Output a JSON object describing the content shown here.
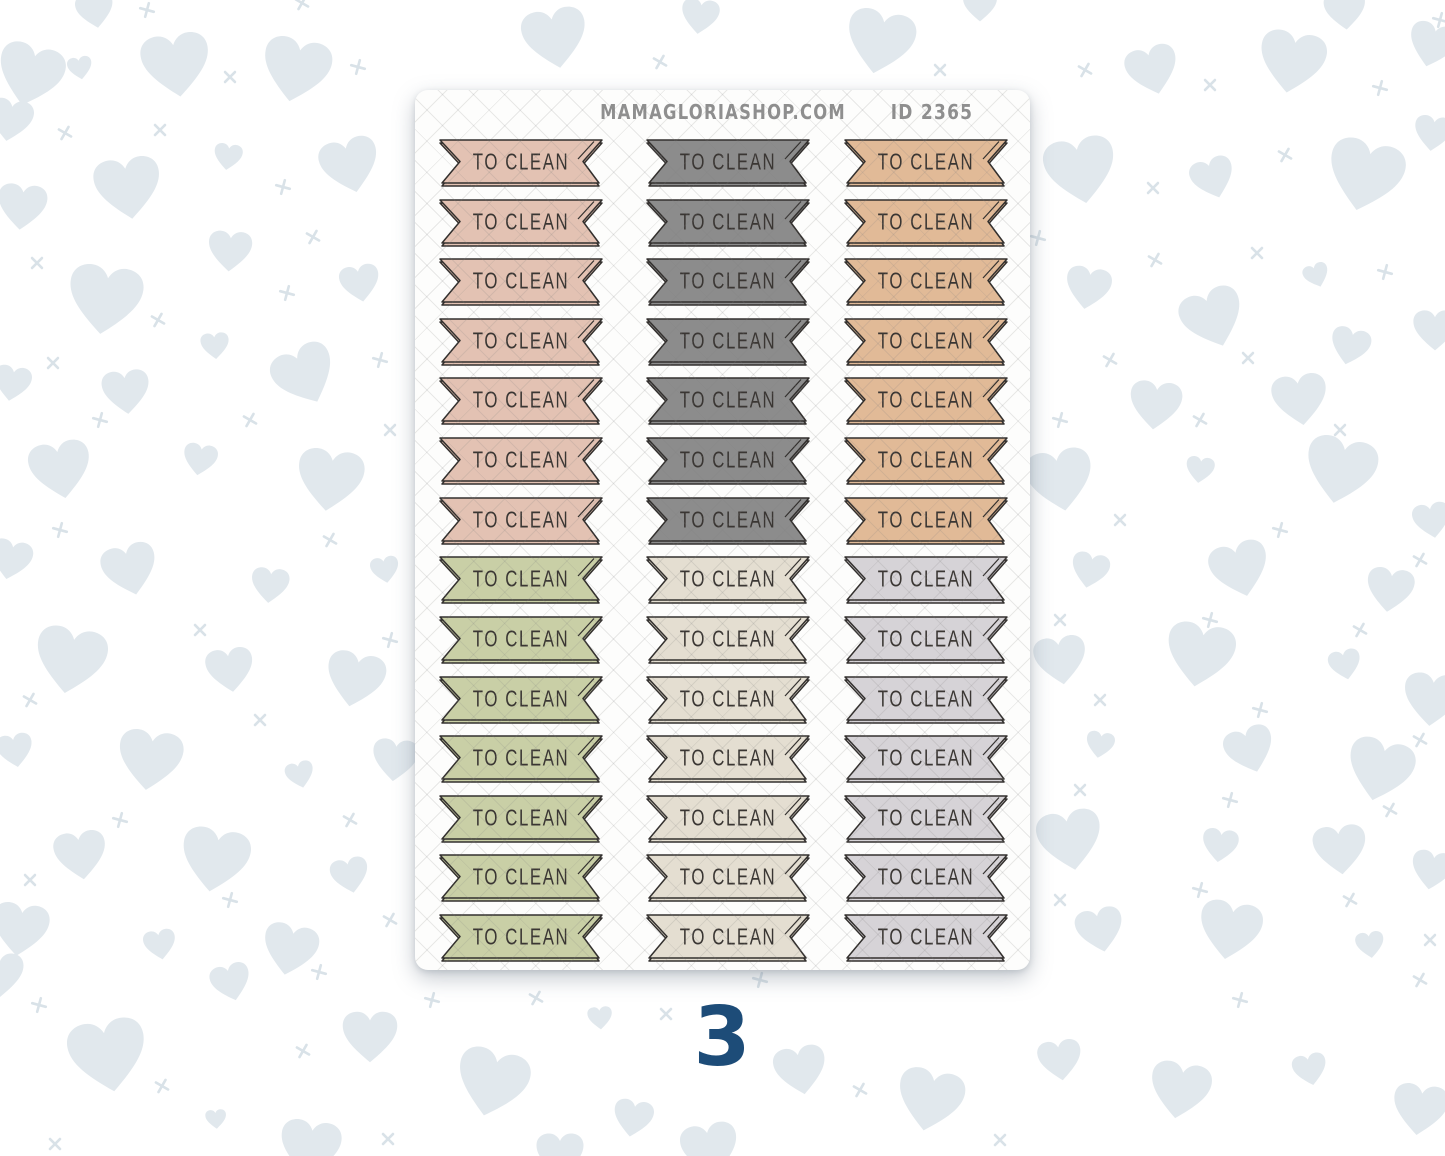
{
  "page": {
    "page_number": "3",
    "page_number_color": "#1d4c78",
    "background_color": "#ffffff",
    "heart_color": "#e1e8ed",
    "cross_color": "#d9e2e8"
  },
  "sheet": {
    "site_name": "MAMAGLORIASHOP.COM",
    "sheet_id": "ID 2365",
    "header_text_color": "#8f8f8f",
    "background_color": "#fdfdfc",
    "outline_color": "#33302e",
    "label_text_color": "#3a3633",
    "flag_label": "TO CLEAN",
    "columns": 3,
    "rows": [
      {
        "label": "TO CLEAN",
        "colors": [
          "#e3c2b3",
          "#8c8c8c",
          "#e1ba97"
        ]
      },
      {
        "label": "TO CLEAN",
        "colors": [
          "#e3c2b3",
          "#8c8c8c",
          "#e1ba97"
        ]
      },
      {
        "label": "TO CLEAN",
        "colors": [
          "#e3c2b3",
          "#8c8c8c",
          "#e1ba97"
        ]
      },
      {
        "label": "TO CLEAN",
        "colors": [
          "#e3c2b3",
          "#8c8c8c",
          "#e1ba97"
        ]
      },
      {
        "label": "TO CLEAN",
        "colors": [
          "#e3c2b3",
          "#8c8c8c",
          "#e1ba97"
        ]
      },
      {
        "label": "TO CLEAN",
        "colors": [
          "#e3c2b3",
          "#8c8c8c",
          "#e1ba97"
        ]
      },
      {
        "label": "TO CLEAN",
        "colors": [
          "#e3c2b3",
          "#8c8c8c",
          "#e1ba97"
        ]
      },
      {
        "label": "TO CLEAN",
        "colors": [
          "#c9cfa6",
          "#e4ded1",
          "#d6d3d7"
        ]
      },
      {
        "label": "TO CLEAN",
        "colors": [
          "#c9cfa6",
          "#e4ded1",
          "#d6d3d7"
        ]
      },
      {
        "label": "TO CLEAN",
        "colors": [
          "#c9cfa6",
          "#e4ded1",
          "#d6d3d7"
        ]
      },
      {
        "label": "TO CLEAN",
        "colors": [
          "#c9cfa6",
          "#e4ded1",
          "#d6d3d7"
        ]
      },
      {
        "label": "TO CLEAN",
        "colors": [
          "#c9cfa6",
          "#e4ded1",
          "#d6d3d7"
        ]
      },
      {
        "label": "TO CLEAN",
        "colors": [
          "#c9cfa6",
          "#e4ded1",
          "#d6d3d7"
        ]
      },
      {
        "label": "TO CLEAN",
        "colors": [
          "#c9cfa6",
          "#e4ded1",
          "#d6d3d7"
        ]
      }
    ]
  }
}
